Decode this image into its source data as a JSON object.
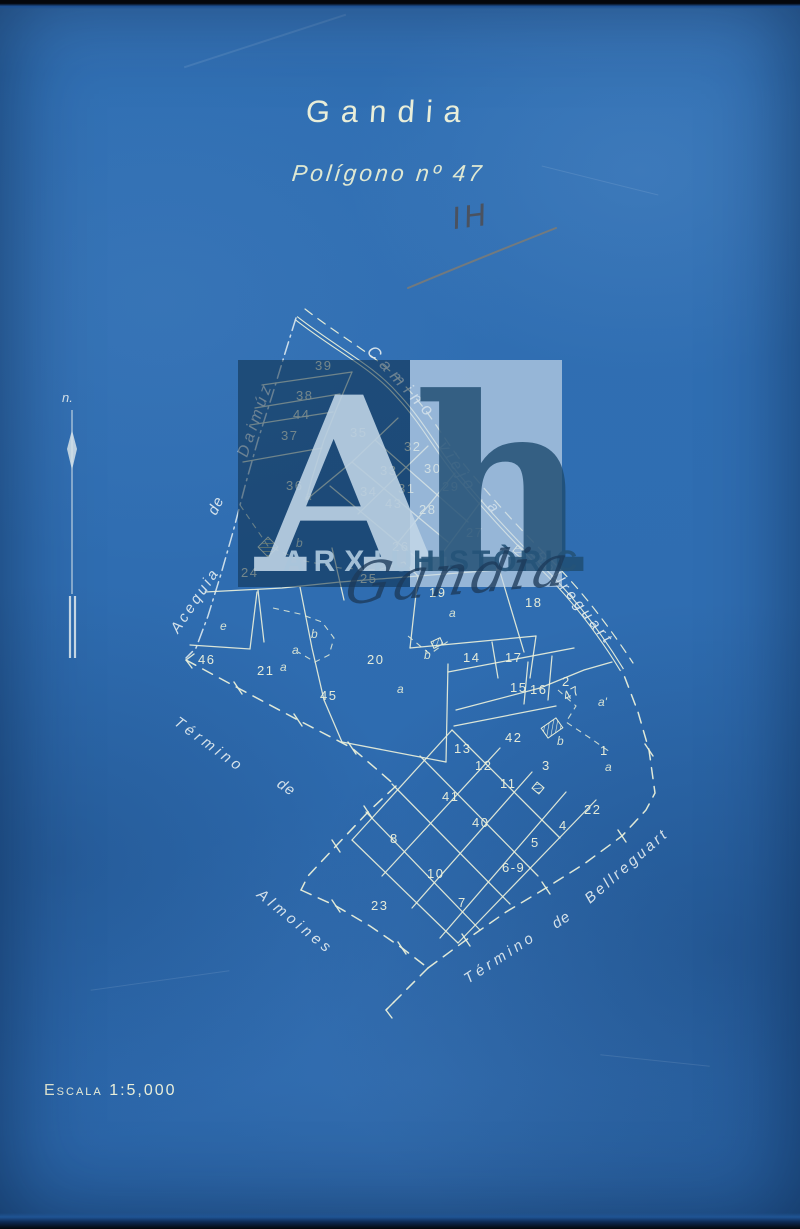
{
  "document": {
    "title": "Gandia",
    "subtitle": "Polígono nº 47",
    "scale_label": "Escala 1:5,000",
    "north_label": "n.",
    "handwritten_mark": "IH"
  },
  "watermark": {
    "initial_a": "A",
    "initial_h": "h",
    "word1": "ARXIU",
    "word2": "HISTÒRIC",
    "script": "Gandia"
  },
  "colors": {
    "paper_blue": "#2f6db1",
    "line_cream": "#eaf0da",
    "pencil_grey": "#4d4f57",
    "watermark_dark": "#0b2a44",
    "watermark_light": "#c7d9e9"
  },
  "map": {
    "road_name": "Camino viejo a Bellreguart",
    "boundary_names": [
      "Acequia de Daimúz",
      "Término de Almoines",
      "Término de Bellreguart"
    ],
    "labels": [
      {
        "text": "Camino",
        "x": 366,
        "y": 352,
        "rot": 47,
        "size": 17,
        "ls": 6
      },
      {
        "text": "viejo",
        "x": 438,
        "y": 446,
        "rot": 57,
        "size": 16,
        "ls": 5
      },
      {
        "text": "a",
        "x": 487,
        "y": 507,
        "rot": 50,
        "size": 15,
        "ls": 0
      },
      {
        "text": "Bellreguart",
        "x": 534,
        "y": 556,
        "rot": 51,
        "size": 15,
        "ls": 4
      },
      {
        "text": "Daimúz",
        "x": 247,
        "y": 458,
        "rot": -71,
        "size": 16,
        "ls": 4
      },
      {
        "text": "de",
        "x": 216,
        "y": 516,
        "rot": -64,
        "size": 15,
        "ls": 1
      },
      {
        "text": "Acequia",
        "x": 178,
        "y": 634,
        "rot": -56,
        "size": 15,
        "ls": 3
      },
      {
        "text": "Término",
        "x": 173,
        "y": 724,
        "rot": 36,
        "size": 15,
        "ls": 4
      },
      {
        "text": "de",
        "x": 276,
        "y": 786,
        "rot": 34,
        "size": 15,
        "ls": 1
      },
      {
        "text": "Almoines",
        "x": 256,
        "y": 896,
        "rot": 39,
        "size": 15,
        "ls": 4
      },
      {
        "text": "Término",
        "x": 468,
        "y": 984,
        "rot": -33,
        "size": 15,
        "ls": 4
      },
      {
        "text": "de",
        "x": 556,
        "y": 929,
        "rot": -33,
        "size": 15,
        "ls": 1
      },
      {
        "text": "Bellreguart",
        "x": 590,
        "y": 904,
        "rot": -41,
        "size": 15,
        "ls": 3
      }
    ],
    "parcels": [
      {
        "n": "39",
        "x": 315,
        "y": 370
      },
      {
        "n": "38",
        "x": 296,
        "y": 400
      },
      {
        "n": "44",
        "x": 293,
        "y": 419
      },
      {
        "n": "37",
        "x": 281,
        "y": 440
      },
      {
        "n": "35",
        "x": 350,
        "y": 437
      },
      {
        "n": "36",
        "x": 286,
        "y": 490
      },
      {
        "n": "32",
        "x": 404,
        "y": 451
      },
      {
        "n": "33",
        "x": 380,
        "y": 475
      },
      {
        "n": "30",
        "x": 424,
        "y": 473
      },
      {
        "n": "29",
        "x": 442,
        "y": 491
      },
      {
        "n": "31",
        "x": 398,
        "y": 493
      },
      {
        "n": "34",
        "x": 360,
        "y": 496
      },
      {
        "n": "43",
        "x": 385,
        "y": 508
      },
      {
        "n": "28",
        "x": 419,
        "y": 514
      },
      {
        "n": "27",
        "x": 466,
        "y": 537
      },
      {
        "n": "26",
        "x": 392,
        "y": 551
      },
      {
        "n": "25",
        "x": 360,
        "y": 583
      },
      {
        "n": "24",
        "x": 241,
        "y": 577
      },
      {
        "n": "19",
        "x": 429,
        "y": 597
      },
      {
        "n": "18",
        "x": 525,
        "y": 607
      },
      {
        "n": "20",
        "x": 367,
        "y": 664
      },
      {
        "n": "21",
        "x": 257,
        "y": 675
      },
      {
        "n": "45",
        "x": 320,
        "y": 700
      },
      {
        "n": "46",
        "x": 198,
        "y": 664
      },
      {
        "n": "14",
        "x": 463,
        "y": 662
      },
      {
        "n": "17",
        "x": 505,
        "y": 662
      },
      {
        "n": "15",
        "x": 510,
        "y": 692
      },
      {
        "n": "16",
        "x": 530,
        "y": 694
      },
      {
        "n": "2",
        "x": 562,
        "y": 686
      },
      {
        "n": "47",
        "x": 566,
        "y": 701,
        "r": -28
      },
      {
        "n": "13",
        "x": 454,
        "y": 753
      },
      {
        "n": "42",
        "x": 505,
        "y": 742
      },
      {
        "n": "12",
        "x": 475,
        "y": 770
      },
      {
        "n": "11",
        "x": 500,
        "y": 788
      },
      {
        "n": "3",
        "x": 542,
        "y": 770
      },
      {
        "n": "1",
        "x": 600,
        "y": 755
      },
      {
        "n": "41",
        "x": 442,
        "y": 801
      },
      {
        "n": "40",
        "x": 472,
        "y": 827
      },
      {
        "n": "22",
        "x": 584,
        "y": 814
      },
      {
        "n": "4",
        "x": 559,
        "y": 830
      },
      {
        "n": "5",
        "x": 531,
        "y": 847
      },
      {
        "n": "8",
        "x": 390,
        "y": 843
      },
      {
        "n": "10",
        "x": 427,
        "y": 878
      },
      {
        "n": "6-9",
        "x": 502,
        "y": 872
      },
      {
        "n": "7",
        "x": 458,
        "y": 907
      },
      {
        "n": "23",
        "x": 371,
        "y": 910
      }
    ],
    "subparcels": [
      {
        "t": "a",
        "x": 305,
        "y": 500
      },
      {
        "t": "b",
        "x": 296,
        "y": 547
      },
      {
        "t": "e",
        "x": 220,
        "y": 630
      },
      {
        "t": "a",
        "x": 280,
        "y": 671
      },
      {
        "t": "b",
        "x": 311,
        "y": 638
      },
      {
        "t": "a",
        "x": 292,
        "y": 654
      },
      {
        "t": "a",
        "x": 397,
        "y": 693
      },
      {
        "t": "b",
        "x": 424,
        "y": 659
      },
      {
        "t": "a",
        "x": 449,
        "y": 617
      },
      {
        "t": "b",
        "x": 557,
        "y": 745
      },
      {
        "t": "a'",
        "x": 598,
        "y": 706
      },
      {
        "t": "a",
        "x": 605,
        "y": 771
      }
    ]
  }
}
